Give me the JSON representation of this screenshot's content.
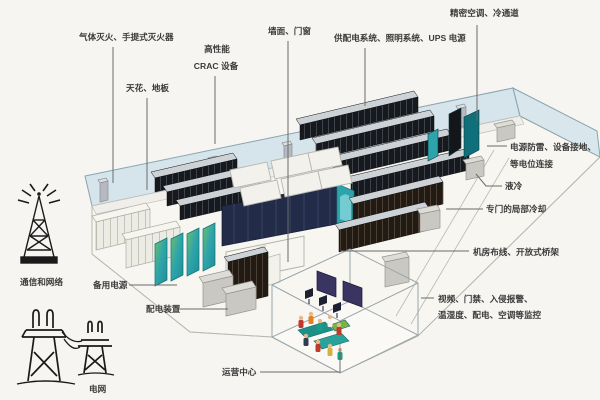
{
  "diagram_title_present": false,
  "labels": {
    "fire": "气体灭火、手提式灭火器",
    "crac_line1": "高性能",
    "crac_line2": "CRAC 设备",
    "ceiling_floor": "天花、地板",
    "wall_door": "墙面、门窗",
    "power_system": "供配电系统、照明系统、UPS 电源",
    "precision_ac": "精密空调、冷通道",
    "lightning_line1": "电源防雷、设备接地、",
    "lightning_line2": "等电位连接",
    "liquid_cooling": "液冷",
    "local_cooling": "专门的局部冷却",
    "cabling": "机房布线、开放式桥架",
    "monitoring_line1": "视频、门禁、入侵报警、",
    "monitoring_line2": "温湿度、配电、空调等监控",
    "ops_center": "运营中心",
    "backup_power": "备用电源",
    "distribution": "配电装置",
    "comm_network": "通信和网络",
    "grid": "电网"
  },
  "icons": {
    "comm_tower": "radio-tower-icon",
    "power_grid": "transmission-pylons-icon"
  },
  "colors": {
    "wall_band": "#cfe2ea",
    "wall_band_edge": "#8aa4b0",
    "floor": "#f7f6f1",
    "floor_edge": "#b2b2a8",
    "rack_dark": "#17191d",
    "rack_top": "#cdd2d6",
    "rack_brown": "#221b14",
    "pod_navy": "#222c48",
    "teal": "#2da4ab",
    "teal_dark": "#0f6f7a",
    "screen_purple": "#3a3462",
    "gray_box": "#c9c8c2",
    "white_cabinet": "#ecebe4",
    "label_text": "#3b3b3b",
    "leader_line": "#6a6a6a"
  }
}
